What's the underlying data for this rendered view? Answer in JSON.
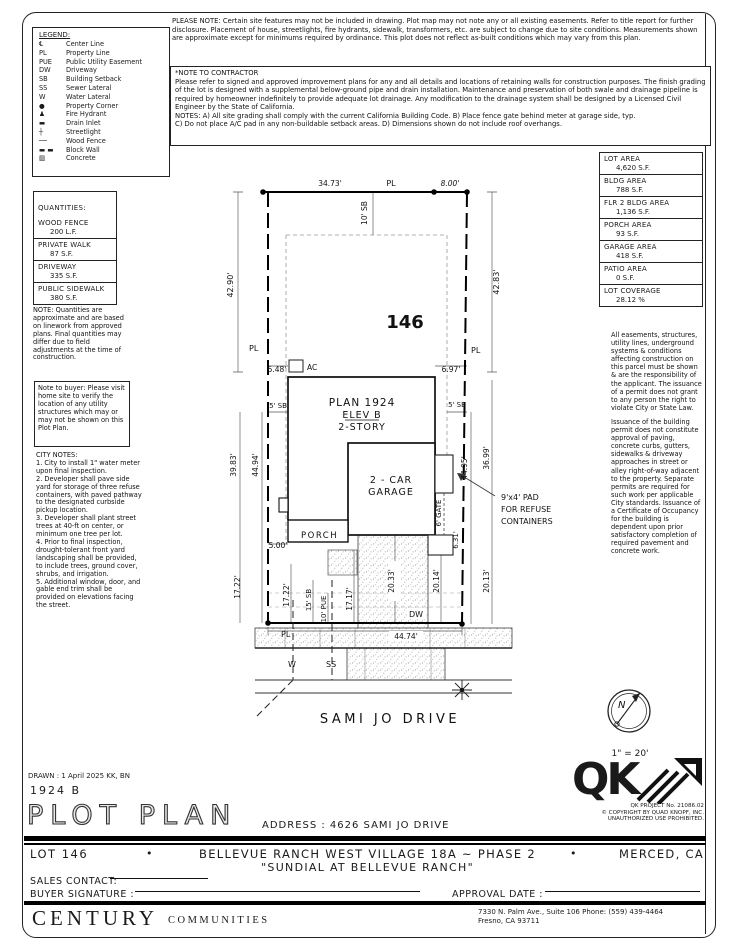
{
  "top_note": "PLEASE NOTE:  Certain site features may not be included in drawing. Plot map may not note any or all existing easements. Refer to title report for further disclosure. Placement of house, streetlights, fire hydrants, sidewalk, transformers, etc. are subject to change due to site conditions. Measurements shown are approximate except for minimums required by ordinance. This plot does not reflect as-built conditions which may vary from this plan.",
  "contractor_note": {
    "title": "*NOTE TO CONTRACTOR",
    "body": "Please refer to signed and approved improvement plans for any and all details and locations of retaining walls for construction purposes. The finish grading of the lot is designed with a supplemental below-ground pipe and drain installation. Maintenance and preservation of both swale and drainage pipeline is required by homeowner indefinitely to provide adequate lot drainage. Any modification to the drainage system shall be designed by a Licensed Civil Engineer by the State of California.",
    "notes_a": "NOTES:  A) All site grading shall comply with the current California Building Code.  B) Place fence gate behind meter at garage side, typ.",
    "notes_b": "C) Do not place A/C pad in any non-buildable setback areas.  D) Dimensions shown do not include roof overhangs."
  },
  "legend": {
    "title": "LEGEND:",
    "items": [
      {
        "name": "center-line",
        "symbol": "℄",
        "label": "Center Line"
      },
      {
        "name": "property-line",
        "symbol": "PL",
        "label": "Property Line"
      },
      {
        "name": "public-utility-easement",
        "symbol": "PUE",
        "label": "Public Utility Easement"
      },
      {
        "name": "driveway",
        "symbol": "DW",
        "label": "Driveway"
      },
      {
        "name": "building-setback",
        "symbol": "SB",
        "label": "Building Setback"
      },
      {
        "name": "sewer-lateral",
        "symbol": "SS",
        "label": "Sewer Lateral"
      },
      {
        "name": "water-lateral",
        "symbol": "W",
        "label": "Water Lateral"
      },
      {
        "name": "property-corner",
        "symbol": "●",
        "label": "Property Corner"
      },
      {
        "name": "fire-hydrant",
        "symbol": "♟",
        "label": "Fire Hydrant"
      },
      {
        "name": "drain-inlet",
        "symbol": "▬",
        "label": "Drain Inlet"
      },
      {
        "name": "streetlight",
        "symbol": "┼",
        "label": "Streetlight"
      },
      {
        "name": "wood-fence",
        "symbol": "──",
        "label": "Wood Fence"
      },
      {
        "name": "block-wall",
        "symbol": "▬ ▬",
        "label": "Block Wall"
      },
      {
        "name": "concrete",
        "symbol": "▨",
        "label": "Concrete"
      }
    ]
  },
  "quantities": {
    "title": "QUANTITIES:",
    "items": [
      {
        "label": "WOOD FENCE",
        "value": "200 L.F."
      },
      {
        "label": "PRIVATE WALK",
        "value": "87 S.F."
      },
      {
        "label": "DRIVEWAY",
        "value": "335 S.F."
      },
      {
        "label": "PUBLIC SIDEWALK",
        "value": "380 S.F."
      }
    ],
    "note": "NOTE: Quantities are approximate and are based on linework from approved plans.  Final quantities may differ due to field adjustments at the time of construction.",
    "buyer_note": "Note to buyer: Please visit home site to verify the location of any utility structures which may or may not be shown on this Plot Plan."
  },
  "city_notes": {
    "title": "CITY NOTES:",
    "items": [
      "1. City to install 1\" water meter upon final inspection.",
      "2. Developer shall pave side yard for storage of three refuse containers, with paved pathway to the designated curbside pickup location.",
      "3. Developer shall plant street trees at 40-ft on center, or minimum one tree per lot.",
      "4. Prior to final inspection, drought-tolerant front yard landscaping shall be provided, to include trees, ground cover, shrubs, and irrigation.",
      "5. Additional window, door, and gable end trim shall be provided on elevations facing the street."
    ]
  },
  "areas": {
    "items": [
      {
        "label": "LOT AREA",
        "value": "4,620 S.F."
      },
      {
        "label": "BLDG AREA",
        "value": "788 S.F."
      },
      {
        "label": "FLR 2 BLDG AREA",
        "value": "1,136 S.F."
      },
      {
        "label": "PORCH AREA",
        "value": "93 S.F."
      },
      {
        "label": "GARAGE AREA",
        "value": "418 S.F."
      },
      {
        "label": "PATIO AREA",
        "value": "0 S.F."
      },
      {
        "label": "LOT COVERAGE",
        "value": "28.12 %"
      }
    ]
  },
  "right_notes": {
    "p1": "All easements, structures, utility lines, underground systems & conditions affecting construction on this parcel must be shown & are the responsibility of the applicant. The issuance of a permit does not grant to any person the right to violate City or State Law.",
    "p2": "Issuance of the building permit does not constitute approval of paving, concrete curbs, gutters, sidewalks & driveway approaches in street or alley right-of-way adjacent to the property. Separate permits are required for such work per applicable City standards. Issuance of a Certificate of Occupancy for the building is dependent upon prior satisfactory completion of required pavement and concrete work."
  },
  "plot": {
    "lot_number": "146",
    "dim_top_left": "34.73'",
    "dim_top_right": "8.00'",
    "pl": "PL",
    "dim_left_side": "42.90'",
    "dim_right_side": "42.83'",
    "sb_rear": "10' SB",
    "dim_ac_left": "5.48'",
    "ac_label": "AC",
    "dim_ac_right": "6.97'",
    "plan_name": "PLAN 1924",
    "plan_elev": "ELEV B",
    "plan_story": "2-STORY",
    "sb_side_left": "5' SB",
    "sb_side_right": "5' SB",
    "dim_left_outer": "39.83'",
    "dim_left_inner": "44.94'",
    "dim_right_inner": "44.95'",
    "dim_right_outer": "36.99'",
    "garage_line1": "2 - CAR",
    "garage_line2": "GARAGE",
    "porch": "PORCH",
    "dim_porch": "5.00'",
    "gate": "6' GATE",
    "dim_gate": "6.31'",
    "refuse_note_lines": [
      "9'x4' PAD",
      "FOR REFUSE",
      "CONTAINERS"
    ],
    "dim_front_1": "17.22'",
    "dim_front_2": "17.22'",
    "sb_front": "15' SB",
    "pue": "10' PUE",
    "dim_front_3": "17.17'",
    "dim_drive": "20.33'",
    "dim_front_4": "20.14'",
    "dim_front_5": "20.13'",
    "dw": "DW",
    "dim_frontage": "44.74'",
    "w": "W",
    "ss": "SS",
    "street_name": "SAMI JO DRIVE",
    "north": "N",
    "scale": "1\" = 20'"
  },
  "titleblock": {
    "drawn": "DRAWN :  1 April 2025   KK, BN",
    "plan_number": "1924  B",
    "sheet_title": "PLOT PLAN",
    "address_label": "ADDRESS :   4626 SAMI JO DRIVE",
    "qk_letters": "QK",
    "qk_caption1": "QK PROJECT No. 21086.02",
    "qk_caption2": "© COPYRIGHT BY QUAD KNOPF, INC.",
    "qk_caption3": "UNAUTHORIZED USE PROHIBITED.",
    "lot_label": "LOT 146",
    "bullet": "•",
    "tract": "BELLEVUE RANCH WEST VILLAGE 18A ~ PHASE 2",
    "city": "MERCED, CA",
    "subtitle": "\"SUNDIAL AT BELLEVUE RANCH\"",
    "sales_contact_label": "SALES CONTACT:",
    "buyer_signature_label": "BUYER SIGNATURE :",
    "approval_date_label": "APPROVAL DATE :"
  },
  "footer": {
    "brand_main": "CENTURY",
    "brand_sub": "COMMUNITIES",
    "address_line1": "7330 N. Palm Ave., Suite 106     Phone:  (559) 439-4464",
    "address_line2": "Fresno, CA  93711"
  }
}
